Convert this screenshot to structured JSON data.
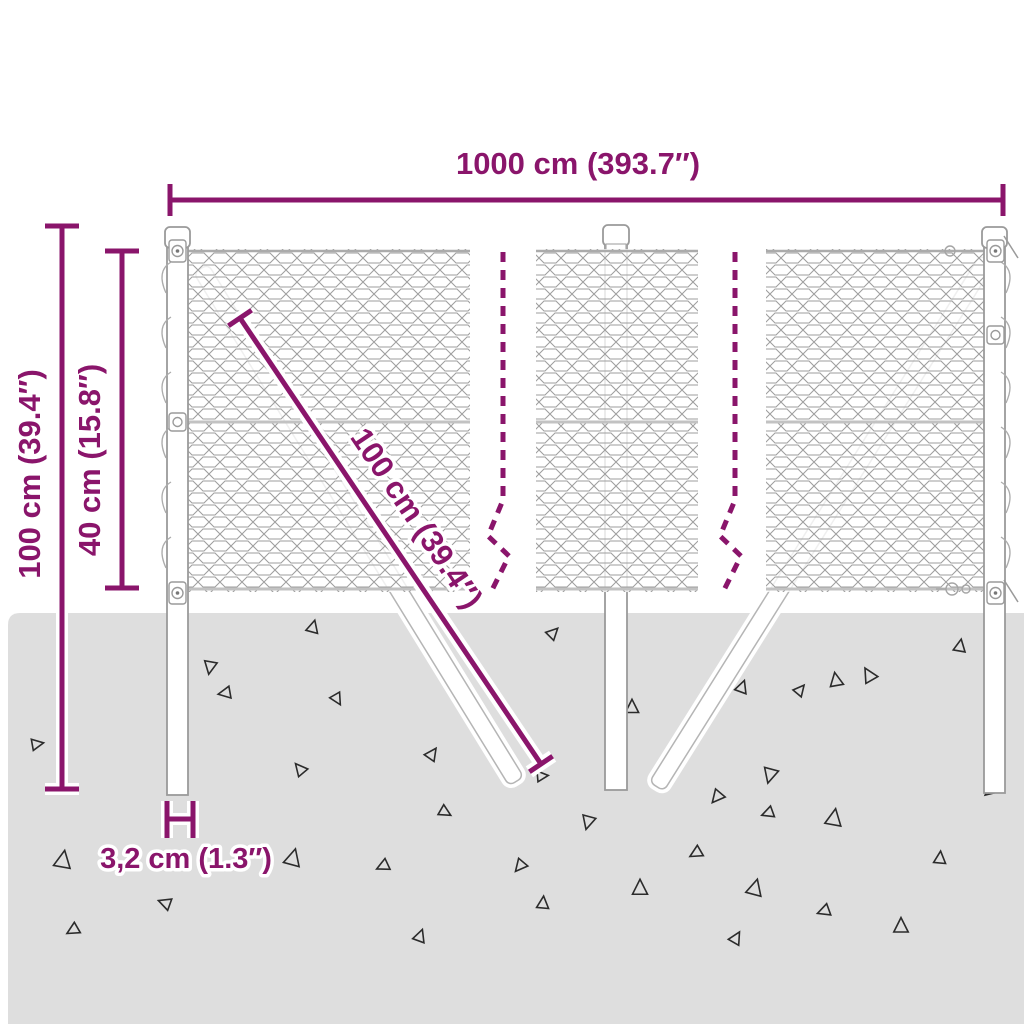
{
  "page": {
    "type": "product-dimension-diagram",
    "subject": "chain-link fence with ground posts and diagonal braces"
  },
  "colors": {
    "accent": "#8a156b",
    "ground": "#dedede",
    "mesh_line": "#9e9e9e",
    "structure_line": "#9a9a9a"
  },
  "labels": {
    "total_width": "1000 cm (393.7″)",
    "total_height": "100 cm (39.4″)",
    "mesh_offset_height": "40 cm (15.8″)",
    "brace_length": "100 cm (39.4″)",
    "post_thickness": "3,2 cm (1.3″)"
  }
}
